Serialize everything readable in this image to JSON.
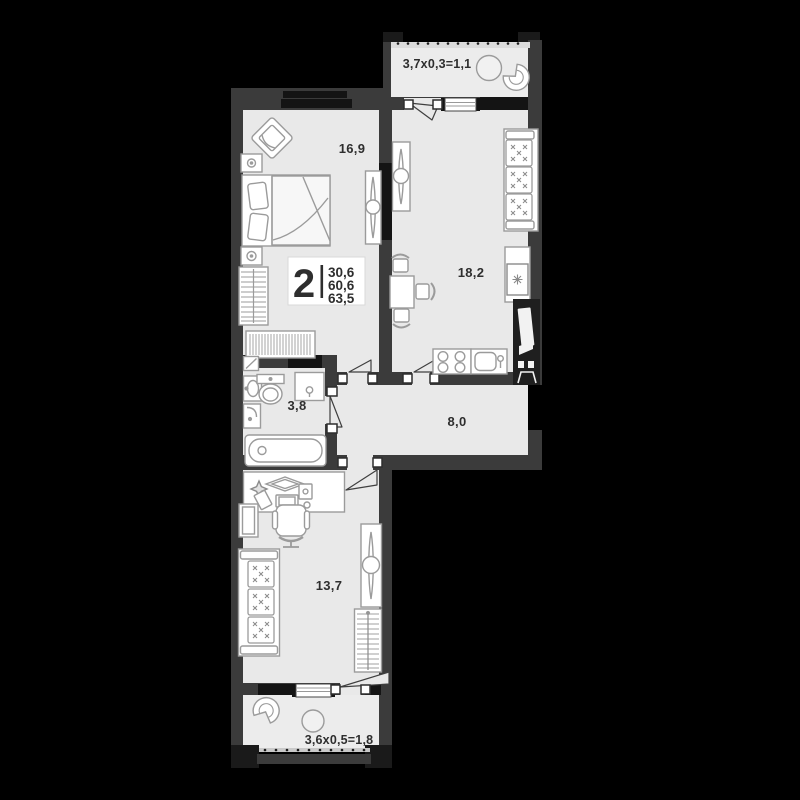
{
  "plan": {
    "badge": {
      "rooms": "2",
      "areas": [
        "30,6",
        "60,6",
        "63,5"
      ]
    },
    "rooms": {
      "bedroom": {
        "label": "16,9"
      },
      "kitchen": {
        "label": "18,2"
      },
      "bathroom": {
        "label": "3,8"
      },
      "hallway": {
        "label": "8,0"
      },
      "living": {
        "label": "13,7"
      }
    },
    "balconies": {
      "top": {
        "label": "3,7х0,3=1,1"
      },
      "bottom": {
        "label": "3,6х0,5=1,8"
      }
    },
    "colors": {
      "background": "#000000",
      "wall": "#3b3b3b",
      "wall_black": "#141414",
      "floor": "#e9e9e9",
      "balcony_floor": "#ececec",
      "furniture_line": "#9b9b9b",
      "entry_module": "#1f1f1f",
      "text": "#2e2e2e",
      "white": "#ffffff"
    }
  }
}
